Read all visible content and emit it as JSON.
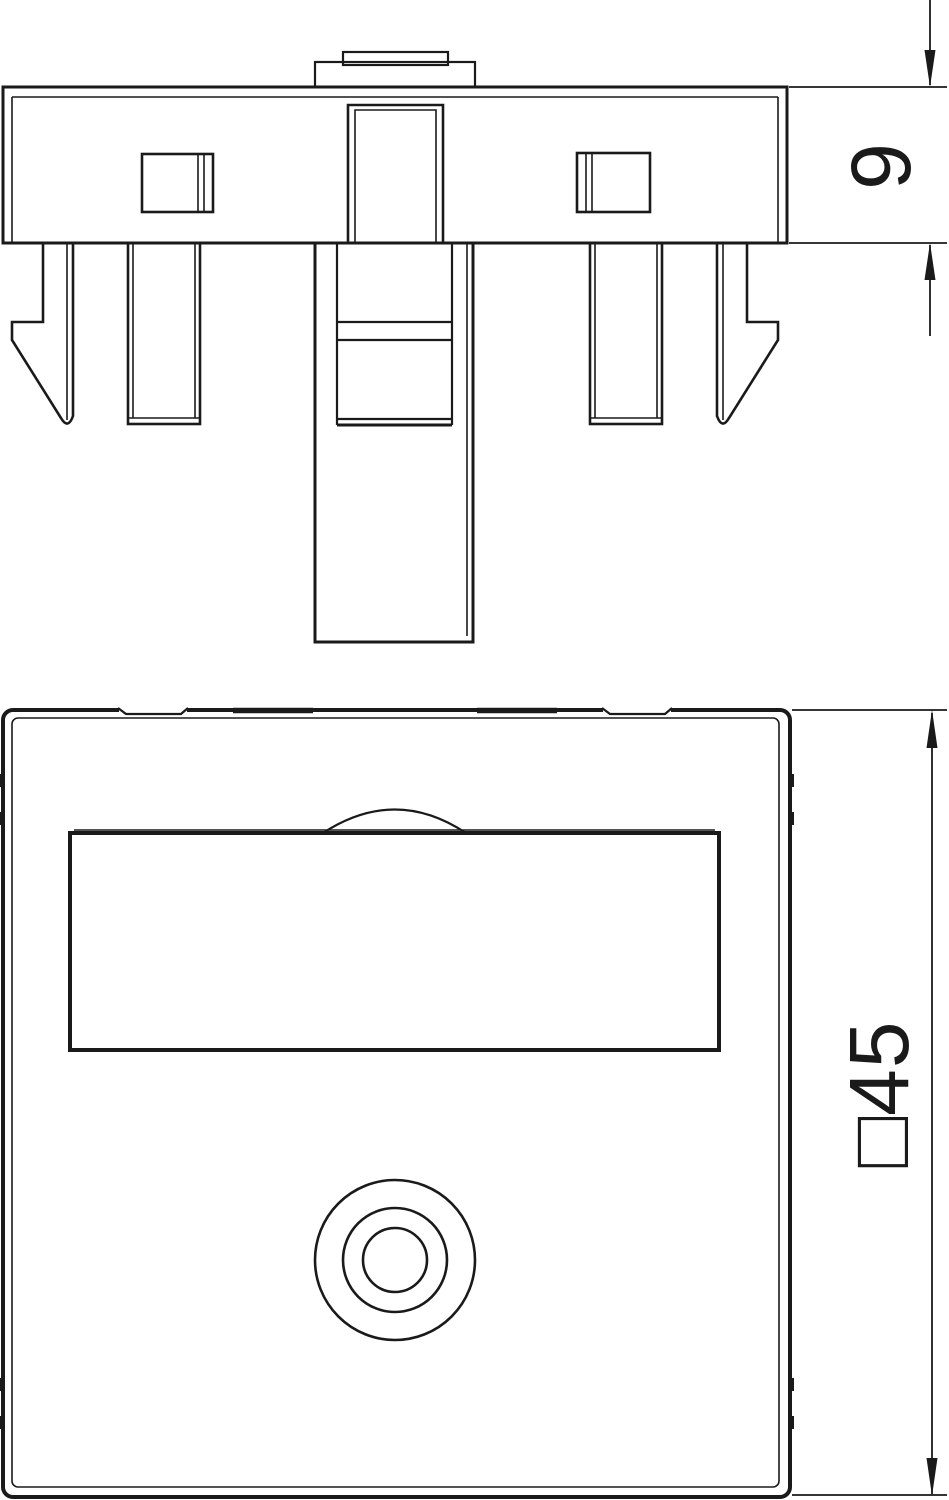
{
  "canvas": {
    "background_color": "#ffffff",
    "line_color": "#1a1a1a"
  },
  "views": {
    "side_view": {
      "id": "side-view"
    },
    "front_view": {
      "id": "front-view"
    }
  },
  "dimensions": {
    "thickness_label": "9",
    "side_label": "□45"
  }
}
